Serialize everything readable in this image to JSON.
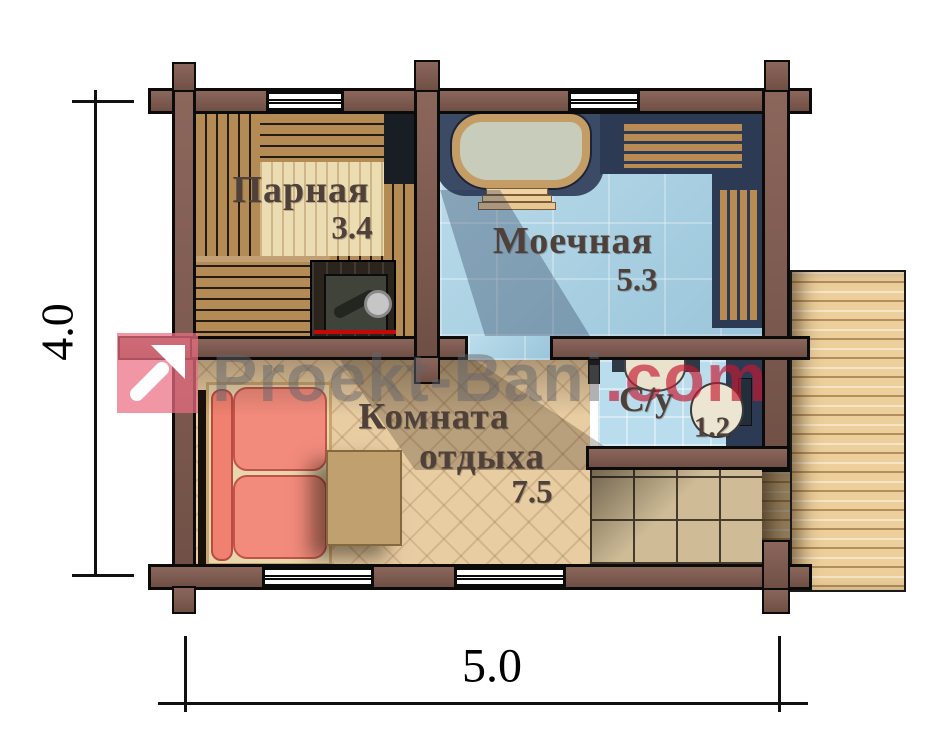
{
  "plan": {
    "dimensions": {
      "height_label": "4.0",
      "width_label": "5.0"
    },
    "rooms": [
      {
        "name": "Парная",
        "area": "3.4"
      },
      {
        "name": "Моечная",
        "area": "5.3"
      },
      {
        "name_line1": "Комната",
        "name_line2": "отдыха",
        "area": "7.5"
      },
      {
        "name": "С/у",
        "area": "1.2"
      }
    ]
  },
  "watermark": {
    "brand": "Proekt-Bani",
    "tld": ".com",
    "logo_icon": "arrow-up-right-icon"
  },
  "colors": {
    "wall_brown": "#7d5a50",
    "tile_blue": "#a9d4e6",
    "parquet_wood": "#e8cda3",
    "bench_wood": "#b48b55",
    "terrace_wood": "#eccf9b",
    "sofa_coral": "#f2887a",
    "navy_shadow": "#2c3a54",
    "label_brown": "#50403a",
    "watermark_red": "#c61830",
    "watermark_gray": "#646469",
    "watermark_pink": "#ea6e82",
    "heat_shield_red": "#c60808"
  }
}
